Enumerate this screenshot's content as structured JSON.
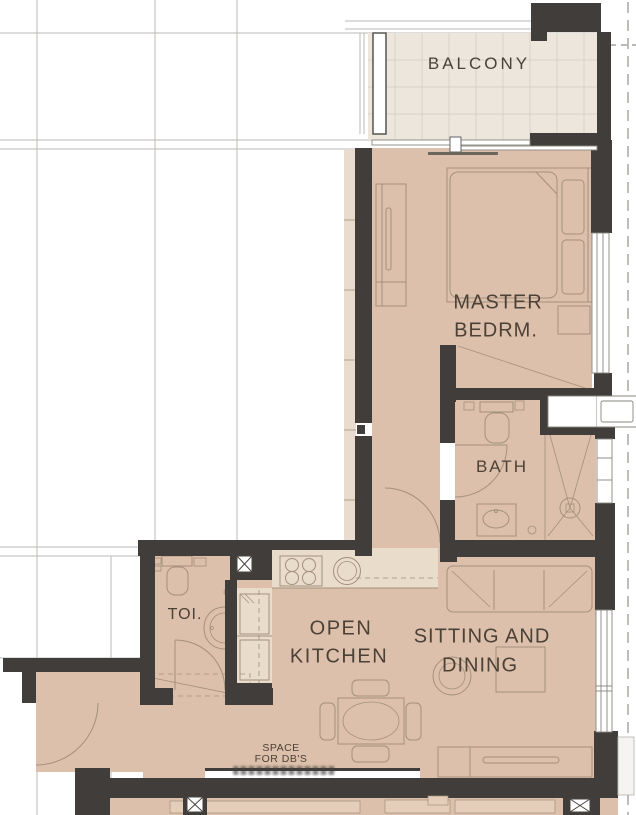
{
  "rooms": {
    "balcony": {
      "label": "BALCONY"
    },
    "master_bedroom": {
      "line1": "MASTER",
      "line2": "BEDRM."
    },
    "bath": {
      "label": "BATH"
    },
    "toilet": {
      "label": "TOI."
    },
    "kitchen": {
      "line1": "OPEN",
      "line2": "KITCHEN"
    },
    "sitting_dining": {
      "line1": "SITTING AND",
      "line2": "DINING"
    }
  },
  "annotations": {
    "db_space": {
      "line1": "SPACE",
      "line2": "FOR DB'S"
    }
  },
  "colors": {
    "paper": "#ffffff",
    "grid": "#bdbab6",
    "dash": "#94908a",
    "wall": "#403d3a",
    "floor": "#ddc0ab",
    "balcony_floor": "#ece6dd",
    "tile_line": "#d9d1c6",
    "counter": "#e9dccb",
    "strip": "#e9dccf",
    "line": "#a3907d",
    "frame": "#8a867f",
    "text": "#4b4136",
    "neighbor": "#e4ceba"
  }
}
